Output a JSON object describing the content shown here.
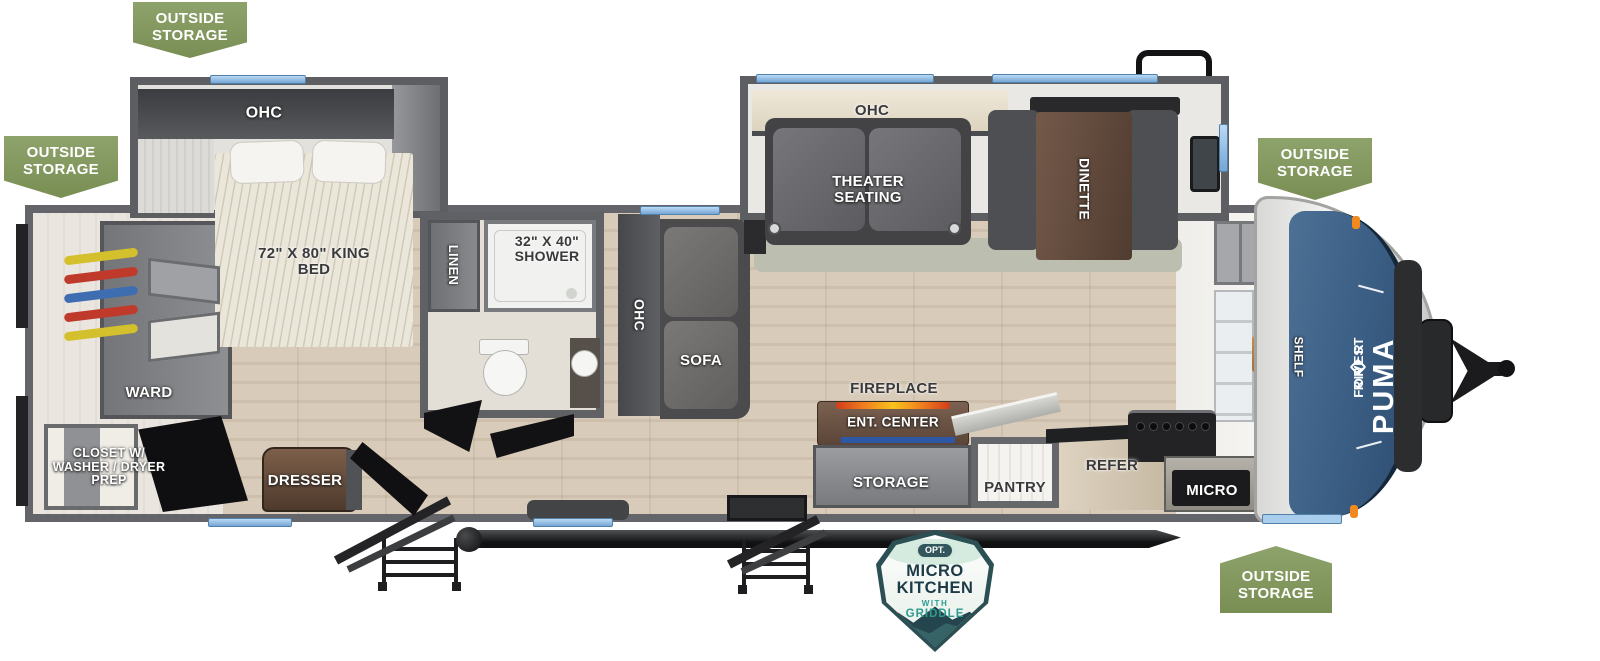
{
  "floorplan": {
    "badges": {
      "outside_storage": "OUTSIDE STORAGE"
    },
    "brand": {
      "maker_word1": "FOREST",
      "maker_word2": "RIVER",
      "model": "PUMA"
    },
    "option_badge": {
      "prefix": "OPT.",
      "line1": "MICRO",
      "line2": "KITCHEN",
      "line3": "WITH",
      "line4": "GRIDDLE"
    },
    "labels": {
      "ohc": "OHC",
      "king_bed": "72\" X 80\" KING BED",
      "linen": "LINEN",
      "shower": "32\" X 40\" SHOWER",
      "ward": "WARD",
      "closet": "CLOSET W/ WASHER / DRYER PREP",
      "dresser": "DRESSER",
      "sofa": "SOFA",
      "theater_seating": "THEATER SEATING",
      "dinette": "DINETTE",
      "fireplace": "FIREPLACE",
      "ent_center": "ENT. CENTER",
      "storage": "STORAGE",
      "pantry": "PANTRY",
      "refer": "REFER",
      "micro": "MICRO",
      "shelf": "SHELF"
    },
    "colors": {
      "badge_green": "#84995E",
      "decal_blue": "#3A5D83",
      "window_blue": "#8FBCE8",
      "wall_gray": "#5D5E62",
      "floor_tan": "#D5C8B6",
      "teal": "#2D9B8F",
      "navy": "#1D3B46",
      "flame_orange": "#F07F1E",
      "fireplace_blue": "#2E57A5"
    }
  }
}
